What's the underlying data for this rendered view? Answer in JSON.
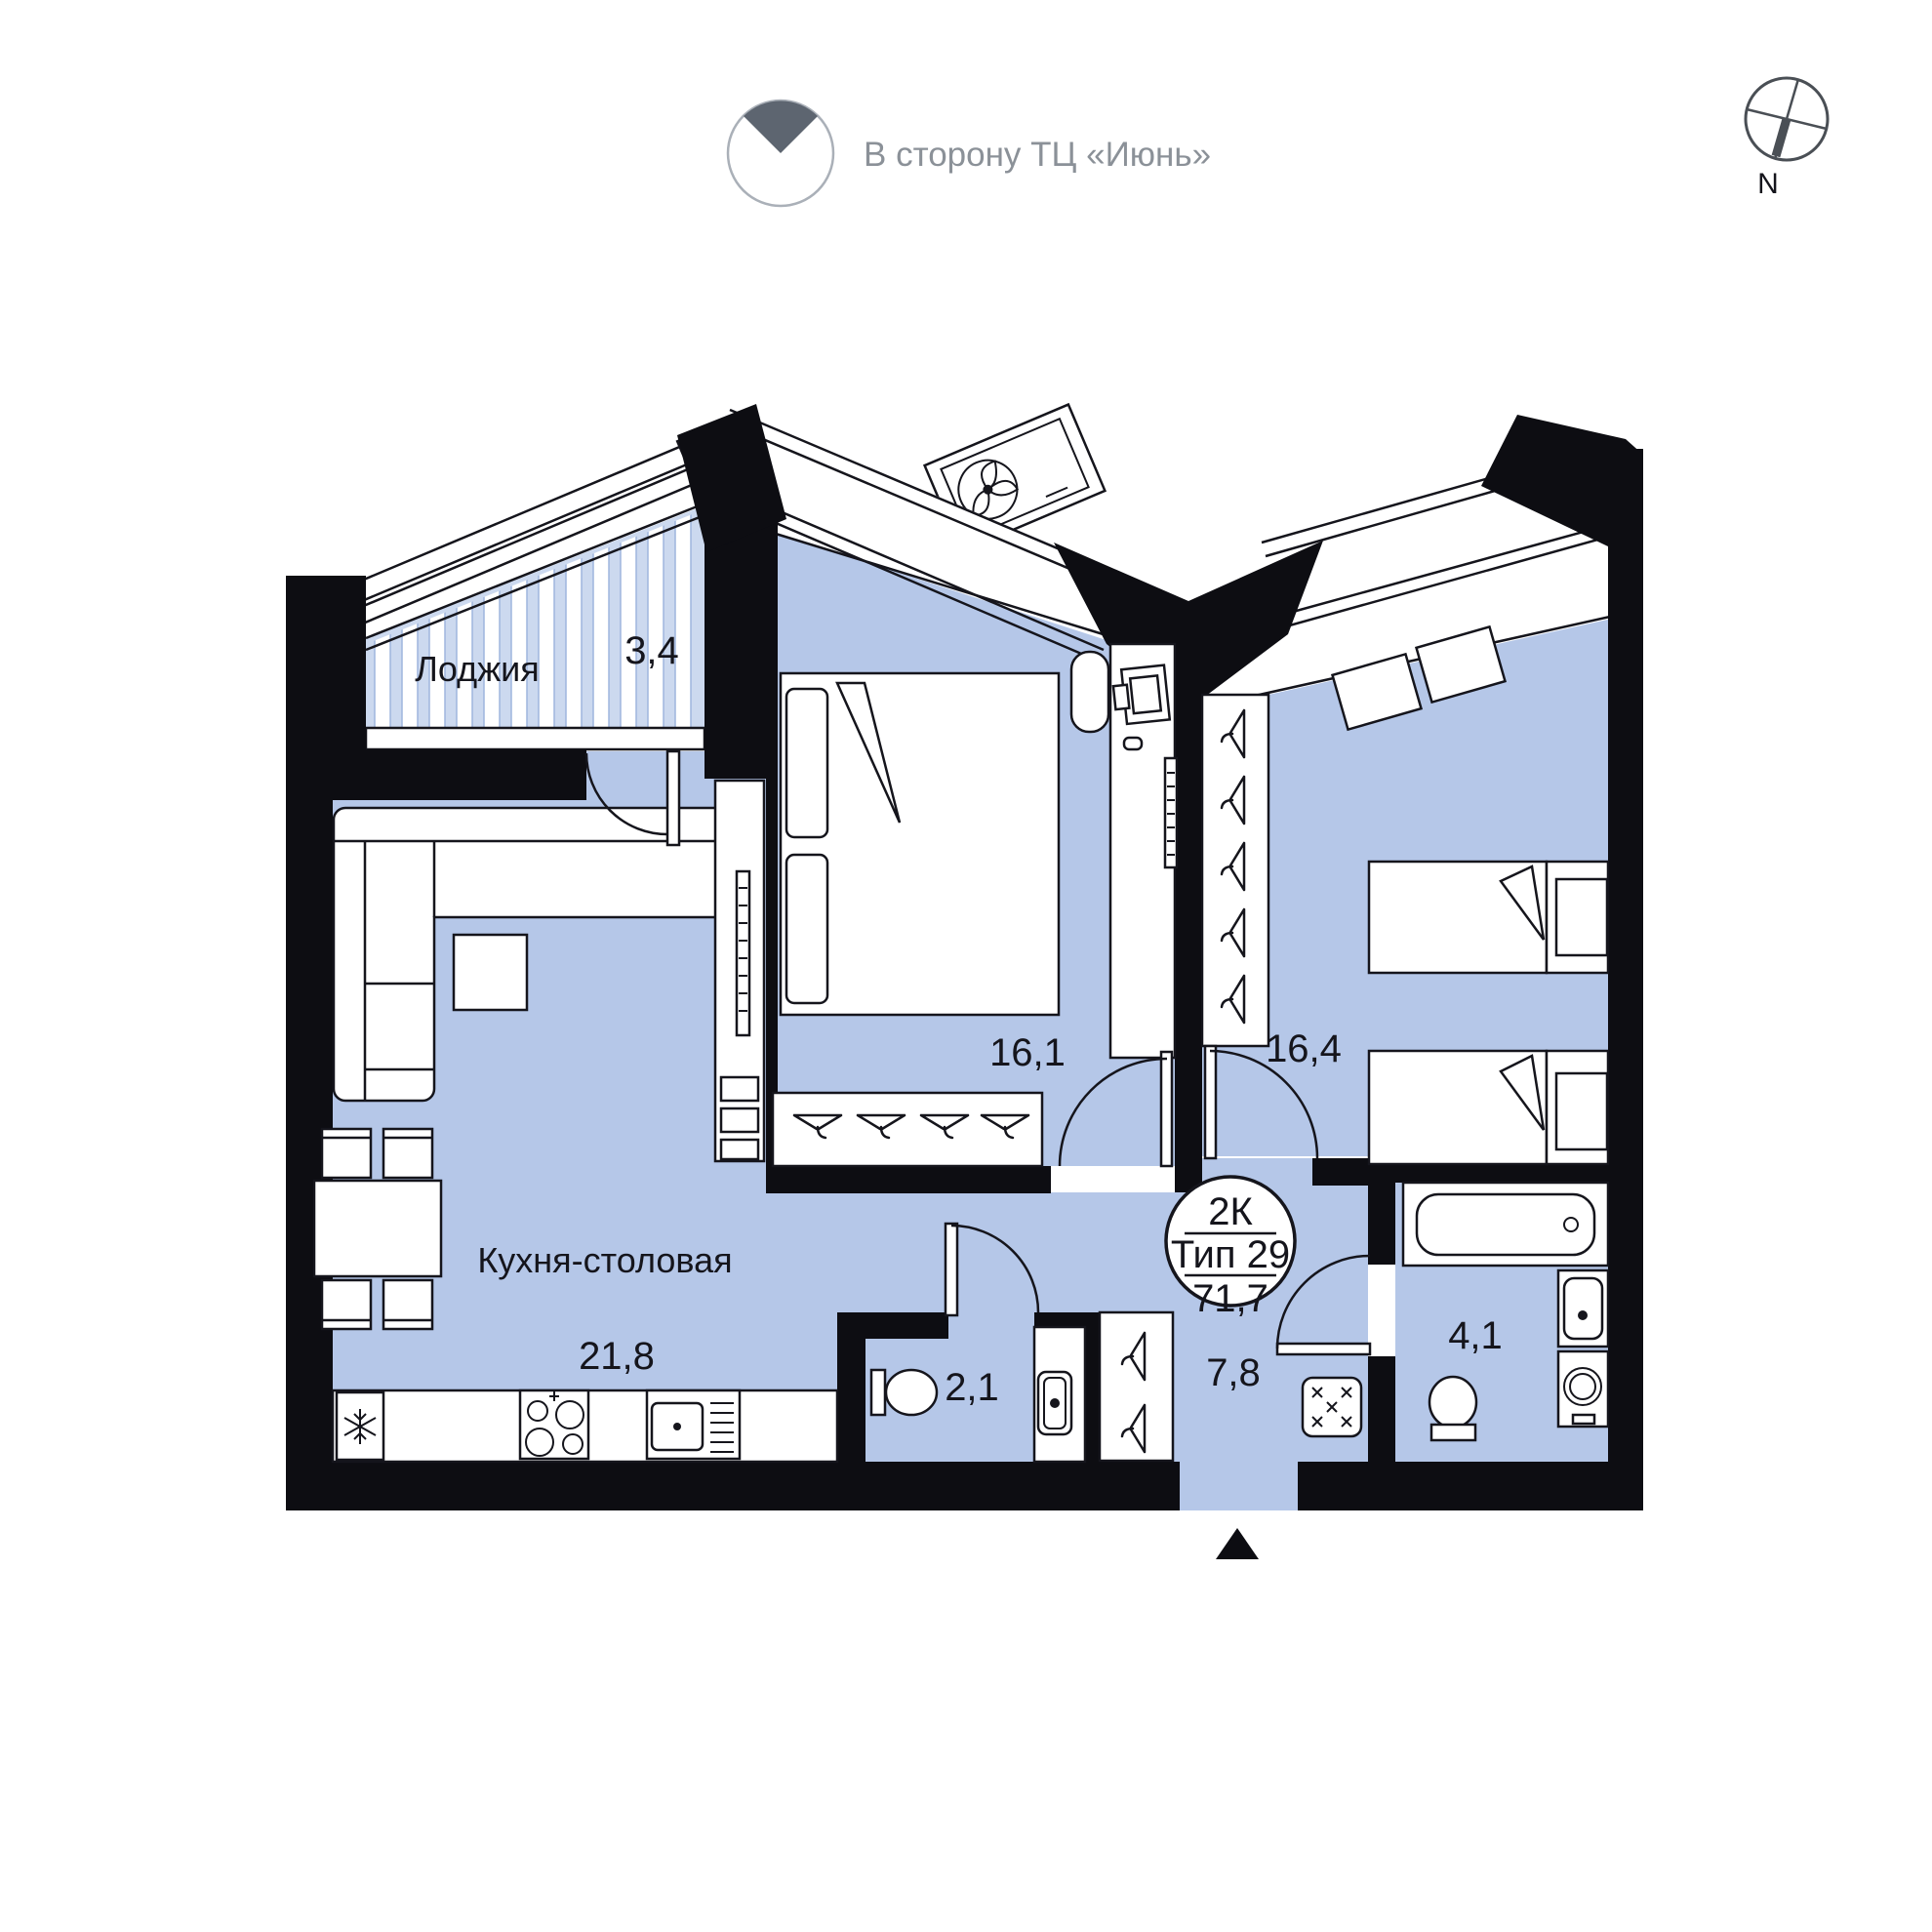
{
  "annotation": {
    "direction_label": "В сторону ТЦ «Июнь»",
    "compass_label": "N"
  },
  "badge": {
    "rooms": "2К",
    "type": "Тип 29",
    "total_area": "71,7"
  },
  "rooms": {
    "loggia": {
      "name": "Лоджия",
      "area": "3,4"
    },
    "bedroom1": {
      "area": "16,1"
    },
    "bedroom2": {
      "area": "16,4"
    },
    "kitchen": {
      "name": "Кухня-столовая",
      "area": "21,8"
    },
    "wc": {
      "area": "2,1"
    },
    "hall": {
      "area": "7,8"
    },
    "bathroom": {
      "area": "4,1"
    }
  },
  "colors": {
    "room_fill": "#b5c7e8",
    "stripe": "#ccd9ef",
    "wall": "#0d0d12",
    "line": "#15151c",
    "annotation_text": "#8b9198",
    "wedge": "#5d6570"
  }
}
